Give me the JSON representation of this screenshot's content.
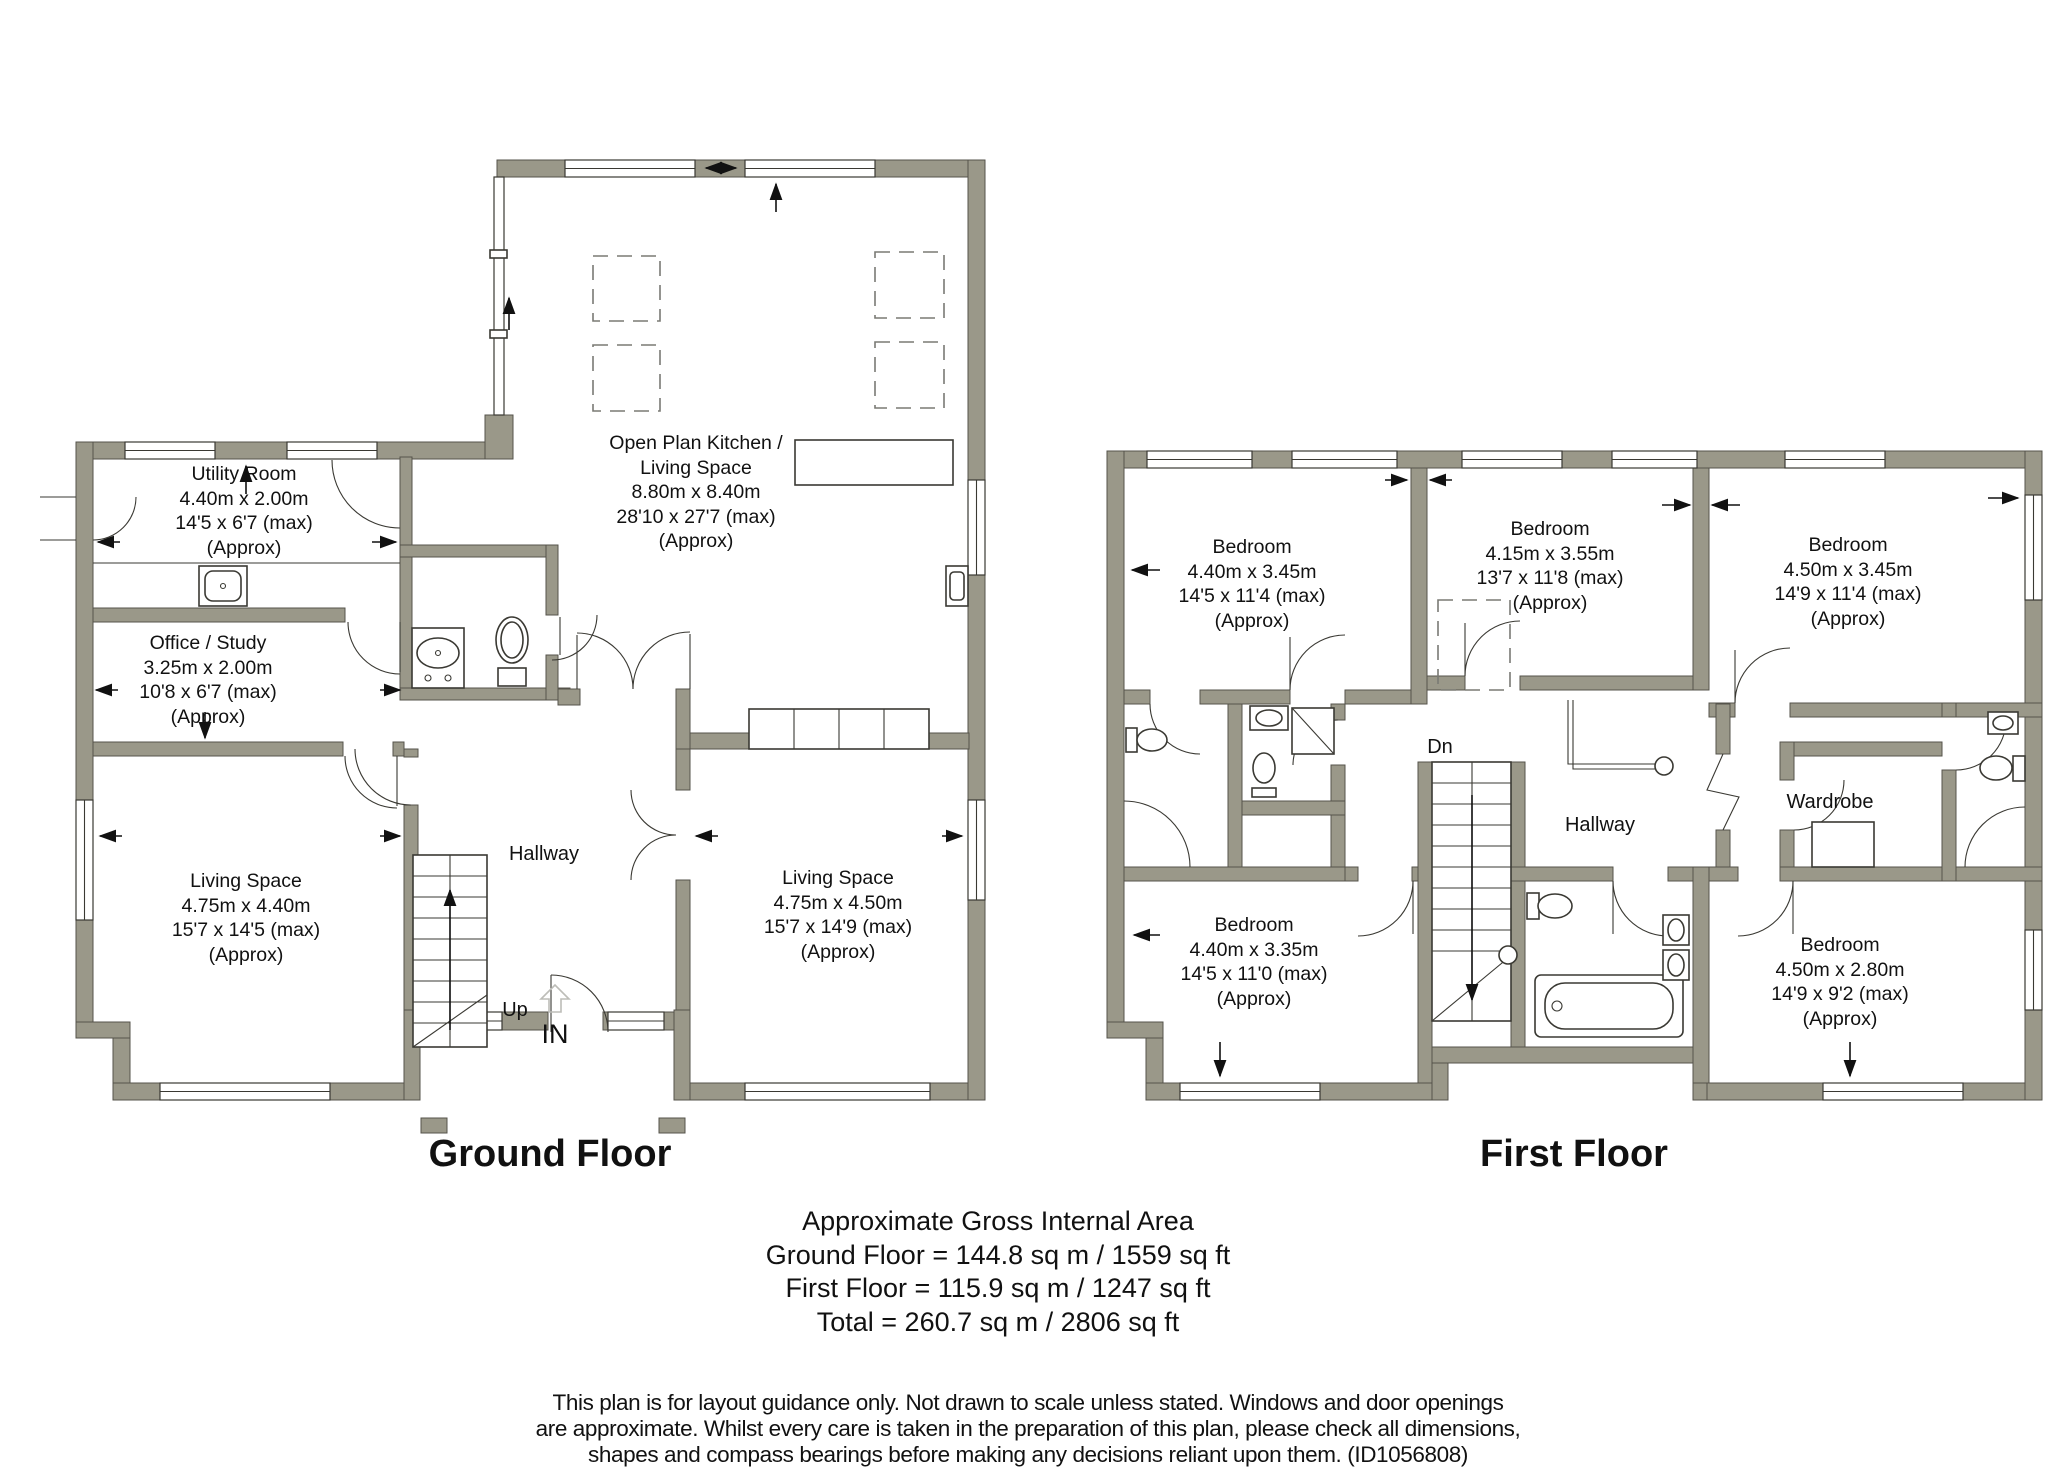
{
  "colors": {
    "wall_fill": "#9a9889",
    "wall_outline": "#55534b",
    "line": "#3a3933",
    "dashed": "#7a7a74",
    "entrance_arrow": "#bdbdb8",
    "text": "#111111"
  },
  "ground_floor": {
    "title": "Ground Floor",
    "labels": {
      "hallway": "Hallway",
      "up": "Up",
      "entrance": "IN"
    },
    "rooms": {
      "utility": {
        "line1": "Utility Room",
        "line2": "4.40m x 2.00m",
        "line3": "14'5 x 6'7 (max)",
        "line4": "(Approx)"
      },
      "office": {
        "line1": "Office / Study",
        "line2": "3.25m x 2.00m",
        "line3": "10'8 x 6'7 (max)",
        "line4": "(Approx)"
      },
      "kitchen": {
        "line1": "Open Plan Kitchen /",
        "line2": "Living Space",
        "line3": "8.80m x 8.40m",
        "line4": "28'10 x 27'7 (max)",
        "line5": "(Approx)"
      },
      "living_left": {
        "line1": "Living Space",
        "line2": "4.75m x 4.40m",
        "line3": "15'7 x 14'5 (max)",
        "line4": "(Approx)"
      },
      "living_right": {
        "line1": "Living Space",
        "line2": "4.75m x 4.50m",
        "line3": "15'7 x 14'9 (max)",
        "line4": "(Approx)"
      }
    }
  },
  "first_floor": {
    "title": "First Floor",
    "labels": {
      "hallway": "Hallway",
      "down": "Dn",
      "wardrobe": "Wardrobe"
    },
    "rooms": {
      "bedroom_top_left": {
        "line1": "Bedroom",
        "line2": "4.40m x 3.45m",
        "line3": "14'5 x 11'4 (max)",
        "line4": "(Approx)"
      },
      "bedroom_top_middle": {
        "line1": "Bedroom",
        "line2": "4.15m x 3.55m",
        "line3": "13'7 x 11'8 (max)",
        "line4": "(Approx)"
      },
      "bedroom_top_right": {
        "line1": "Bedroom",
        "line2": "4.50m x 3.45m",
        "line3": "14'9 x 11'4 (max)",
        "line4": "(Approx)"
      },
      "bedroom_bottom_left": {
        "line1": "Bedroom",
        "line2": "4.40m x 3.35m",
        "line3": "14'5 x 11'0 (max)",
        "line4": "(Approx)"
      },
      "bedroom_bottom_right": {
        "line1": "Bedroom",
        "line2": "4.50m x 2.80m",
        "line3": "14'9 x 9'2 (max)",
        "line4": "(Approx)"
      }
    }
  },
  "summary": {
    "heading": "Approximate Gross Internal Area",
    "ground": "Ground Floor = 144.8 sq m / 1559 sq ft",
    "first": "First Floor = 115.9 sq m / 1247 sq ft",
    "total": "Total = 260.7 sq m / 2806 sq ft"
  },
  "disclaimer": {
    "line1": "This plan is for layout guidance only. Not drawn to scale unless stated. Windows and door openings",
    "line2": "are approximate. Whilst every care is taken in the preparation of this plan, please check all dimensions,",
    "line3": "shapes and compass bearings before making any decisions reliant upon them. (ID1056808)"
  }
}
